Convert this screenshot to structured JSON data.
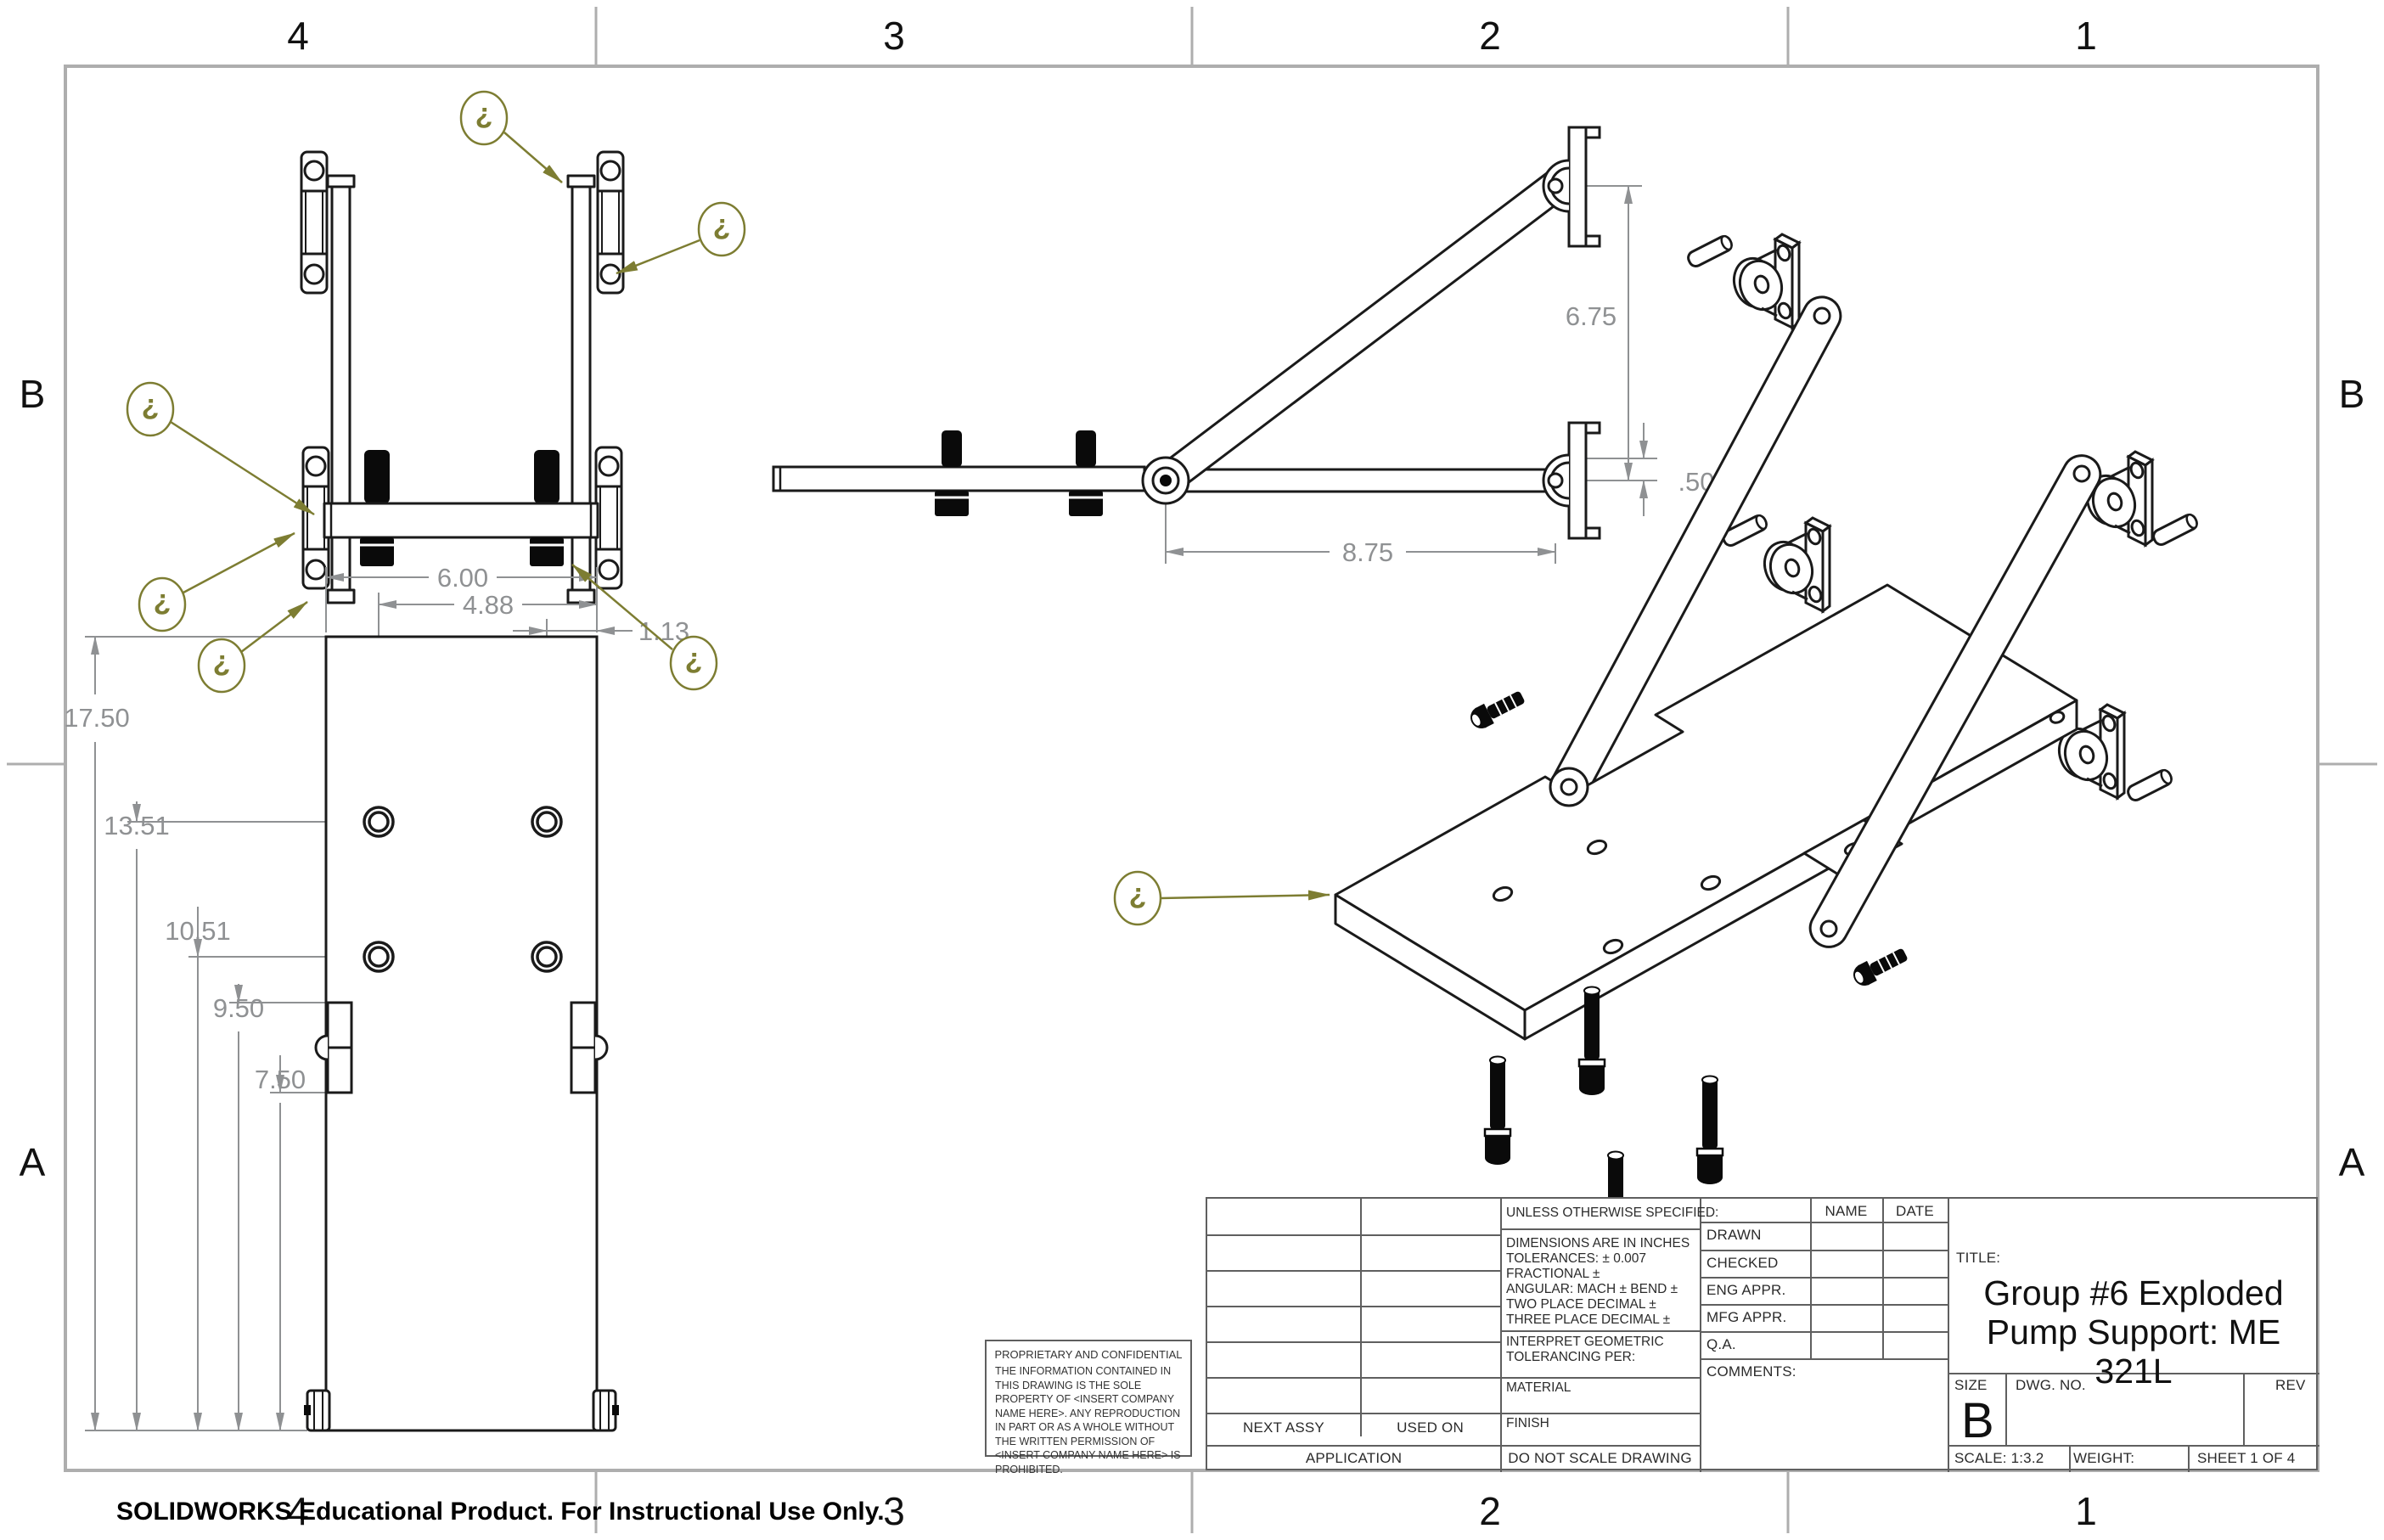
{
  "sheet": {
    "zones_top": [
      "4",
      "3",
      "2",
      "1"
    ],
    "zones_bottom": [
      "4",
      "3",
      "2",
      "1"
    ],
    "zones_left": [
      "B",
      "A"
    ],
    "zones_right": [
      "B",
      "A"
    ],
    "footer": "SOLIDWORKS Educational Product. For Instructional Use Only."
  },
  "colors": {
    "line": "#1a1a1a",
    "dim": "#8f9193",
    "olive": "#7d7d32",
    "frame": "#aeaeae"
  },
  "balloon_char": "?",
  "views": {
    "side": {
      "dim_vertical": "6.75",
      "dim_offset": ".50",
      "dim_horizontal": "8.75"
    },
    "bottom": {
      "dim_17": "17.50",
      "dim_13": "13.51",
      "dim_10": "10.51",
      "dim_9": "9.50",
      "dim_7": "7.50",
      "dim_6": "6.00",
      "dim_4": "4.88",
      "dim_1": "1.13"
    }
  },
  "title_block": {
    "unless": "UNLESS OTHERWISE SPECIFIED:",
    "spec1": "DIMENSIONS ARE IN INCHES",
    "spec2": "TOLERANCES: ± 0.007",
    "spec3": "FRACTIONAL ±",
    "spec4": "ANGULAR: MACH ±    BEND ±",
    "spec5": "TWO PLACE DECIMAL    ±",
    "spec6": "THREE PLACE DECIMAL  ±",
    "interpret1": "INTERPRET GEOMETRIC",
    "interpret2": "TOLERANCING PER:",
    "material": "MATERIAL",
    "finish": "FINISH",
    "do_not_scale": "DO NOT SCALE DRAWING",
    "name": "NAME",
    "date": "DATE",
    "row_drawn": "DRAWN",
    "row_checked": "CHECKED",
    "row_eng": "ENG APPR.",
    "row_mfg": "MFG APPR.",
    "row_qa": "Q.A.",
    "comments": "COMMENTS:",
    "title_label": "TITLE:",
    "title_line1": "Group #6 Exploded",
    "title_line2": "Pump Support: ME",
    "title_line3": "321L",
    "size_label": "SIZE",
    "size_value": "B",
    "dwg_label": "DWG.  NO.",
    "rev_label": "REV",
    "scale": "SCALE: 1:3.2",
    "weight": "WEIGHT:",
    "sheet_of": "SHEET 1 OF 4",
    "next_assy": "NEXT ASSY",
    "used_on": "USED ON",
    "application": "APPLICATION",
    "proprietary_title": "PROPRIETARY AND CONFIDENTIAL",
    "proprietary_body": "THE INFORMATION CONTAINED IN THIS DRAWING IS THE SOLE PROPERTY OF <INSERT COMPANY NAME HERE>.  ANY REPRODUCTION IN PART OR AS A WHOLE WITHOUT THE WRITTEN PERMISSION OF <INSERT COMPANY NAME HERE> IS PROHIBITED."
  }
}
